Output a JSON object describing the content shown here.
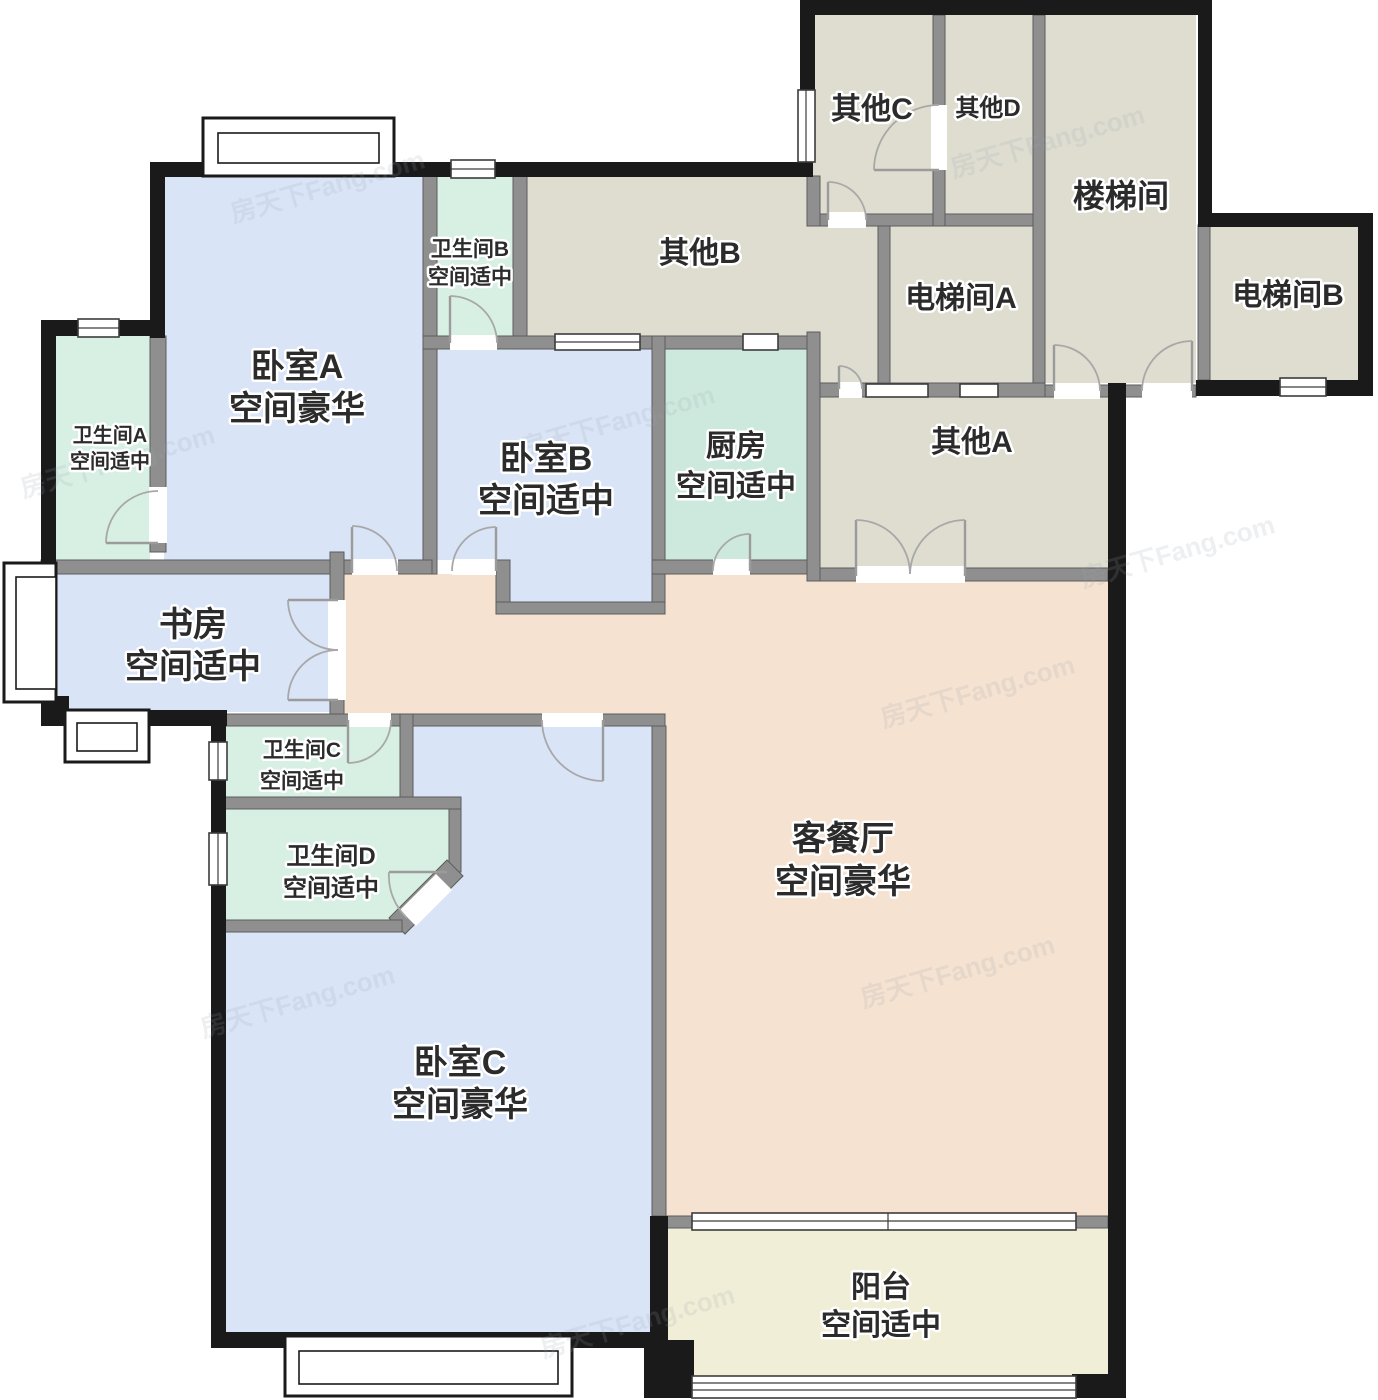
{
  "watermark": "房天下Fang.com",
  "colors": {
    "bedroom": "#d9e4f7",
    "bath": "#d8efe4",
    "kitchen": "#cde9de",
    "public": "#deddd0",
    "living": "#f5e2d1",
    "balcony": "#f0eed7",
    "inner_wall": "#8f8f8f",
    "outer_wall": "#1a1a1a",
    "label": "#2b2b2b"
  },
  "rooms": [
    {
      "name": "卧室A",
      "size": "空间豪华"
    },
    {
      "name": "卧室B",
      "size": "空间适中"
    },
    {
      "name": "卧室C",
      "size": "空间豪华"
    },
    {
      "name": "书房",
      "size": "空间适中"
    },
    {
      "name": "厨房",
      "size": "空间适中"
    },
    {
      "name": "客餐厅",
      "size": "空间豪华"
    },
    {
      "name": "阳台",
      "size": "空间适中"
    },
    {
      "name": "卫生间A",
      "size": "空间适中"
    },
    {
      "name": "卫生间B",
      "size": "空间适中"
    },
    {
      "name": "卫生间C",
      "size": "空间适中"
    },
    {
      "name": "卫生间D",
      "size": "空间适中"
    },
    {
      "name": "其他A"
    },
    {
      "name": "其他B"
    },
    {
      "name": "其他C"
    },
    {
      "name": "其他D"
    },
    {
      "name": "楼梯间"
    },
    {
      "name": "电梯间A"
    },
    {
      "name": "电梯间B"
    }
  ]
}
